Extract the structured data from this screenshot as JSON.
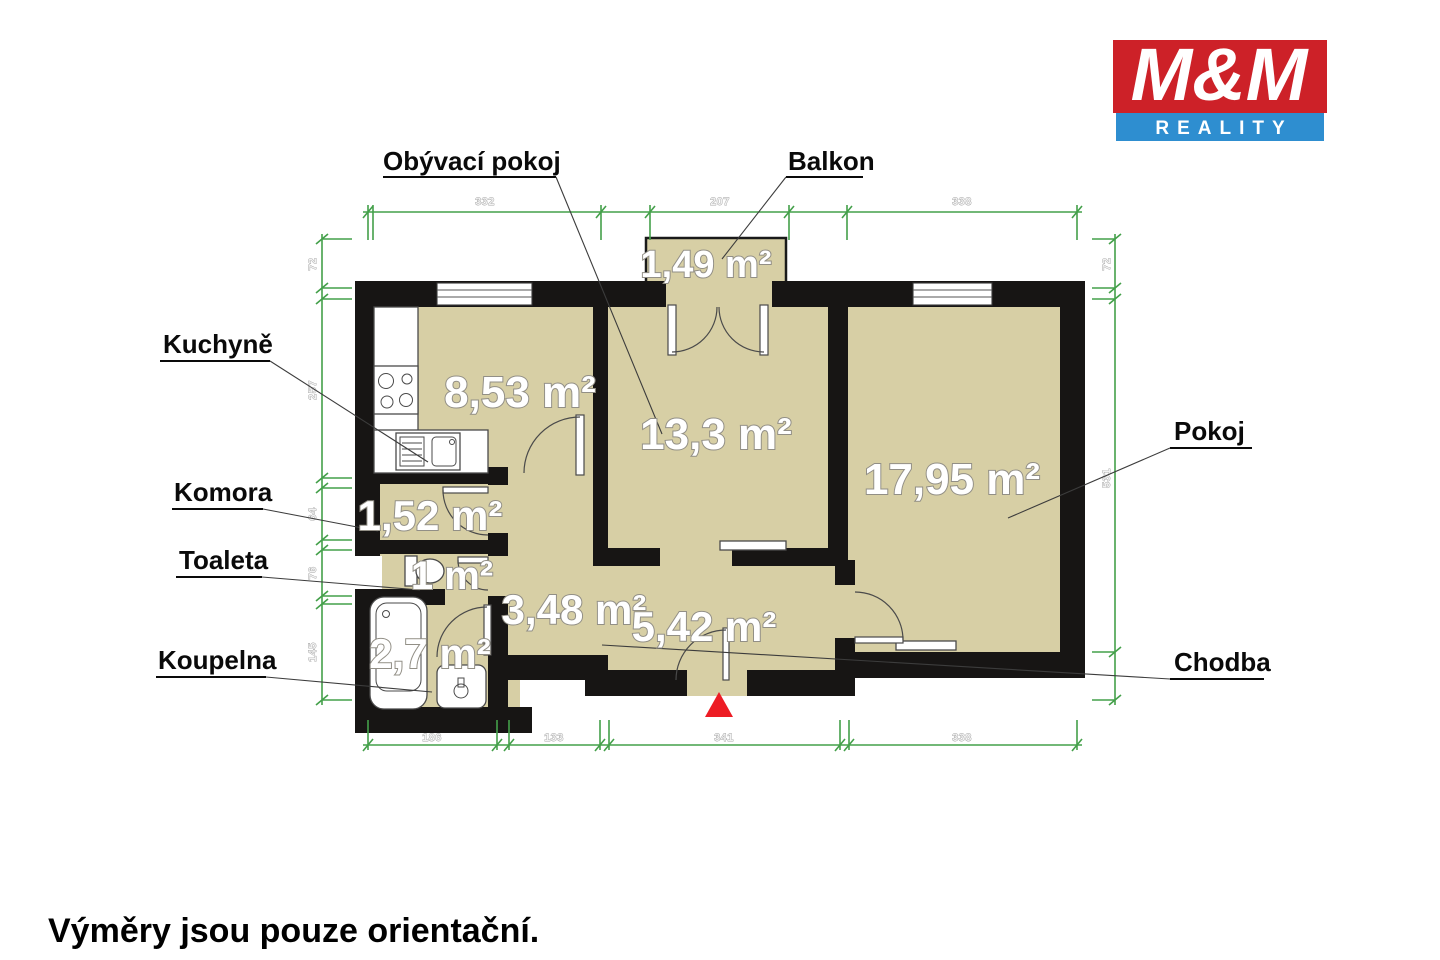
{
  "logo": {
    "name": "M&M",
    "tagline": "REALITY"
  },
  "disclaimer": "Výměry jsou pouze orientační.",
  "labels": {
    "obyvaci_pokoj": "Obývací pokoj",
    "balkon": "Balkon",
    "kuchyne": "Kuchyně",
    "komora": "Komora",
    "toaleta": "Toaleta",
    "koupelna": "Koupelna",
    "pokoj": "Pokoj",
    "chodba": "Chodba"
  },
  "areas": {
    "obyvaci_pokoj": "13,3 m²",
    "balkon": "1,49 m²",
    "kuchyne": "8,53 m²",
    "komora": "1,52 m²",
    "toaleta": "1 m²",
    "koupelna": "2,7 m²",
    "pokoj": "17,95 m²",
    "chodba": "5,42 m²",
    "chodba_stred": "3,48 m²"
  },
  "dimensions_cm": {
    "top": [
      "332",
      "207",
      "338"
    ],
    "bottom": [
      "186",
      "133",
      "341",
      "338"
    ],
    "left": [
      "72",
      "257",
      "64",
      "76",
      "145"
    ],
    "right": [
      "72",
      "531"
    ]
  },
  "colors": {
    "floor": "#d7cfa5",
    "wall": "#171514",
    "dimension_green": "#44a04a",
    "logo_red": "#cd2128",
    "logo_blue": "#2e8ed0",
    "entrance_marker_red": "#ed1c24"
  }
}
